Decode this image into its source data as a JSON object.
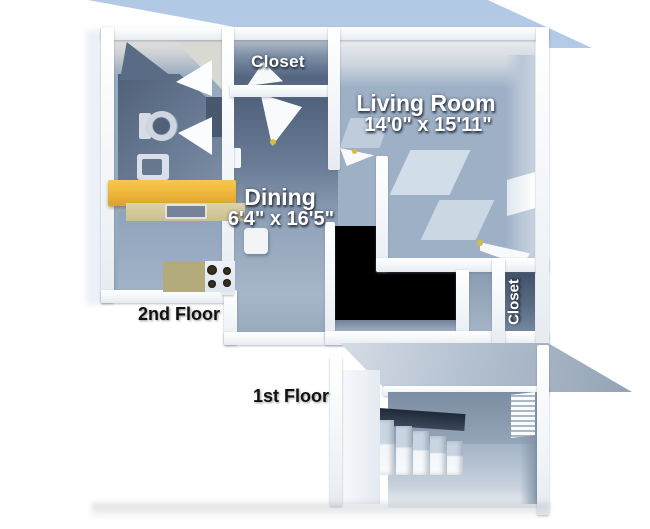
{
  "title": "Apartment 3D Floor Plan",
  "floors": {
    "second": {
      "label": "2nd Floor",
      "rooms": {
        "closet_top": {
          "label": "Closet"
        },
        "living_room": {
          "label": "Living Room",
          "dimensions": "14'0\" x 15'11\""
        },
        "dining": {
          "label": "Dining",
          "dimensions": "6'4\" x 16'5\""
        },
        "closet_side": {
          "label": "Closet"
        }
      }
    },
    "first": {
      "label": "1st Floor"
    }
  },
  "colors": {
    "backdrop_blue": "#b7cde8",
    "wall_white": "#f8fafc",
    "floor_blue_gray": "#93a7bf",
    "dark_room_blue": "#52647e",
    "stairwell_void_black": "#000000",
    "counter_yellow": "#edb53a",
    "counter_tan": "#cfc394",
    "stove_burner_brown": "#372f1f"
  }
}
